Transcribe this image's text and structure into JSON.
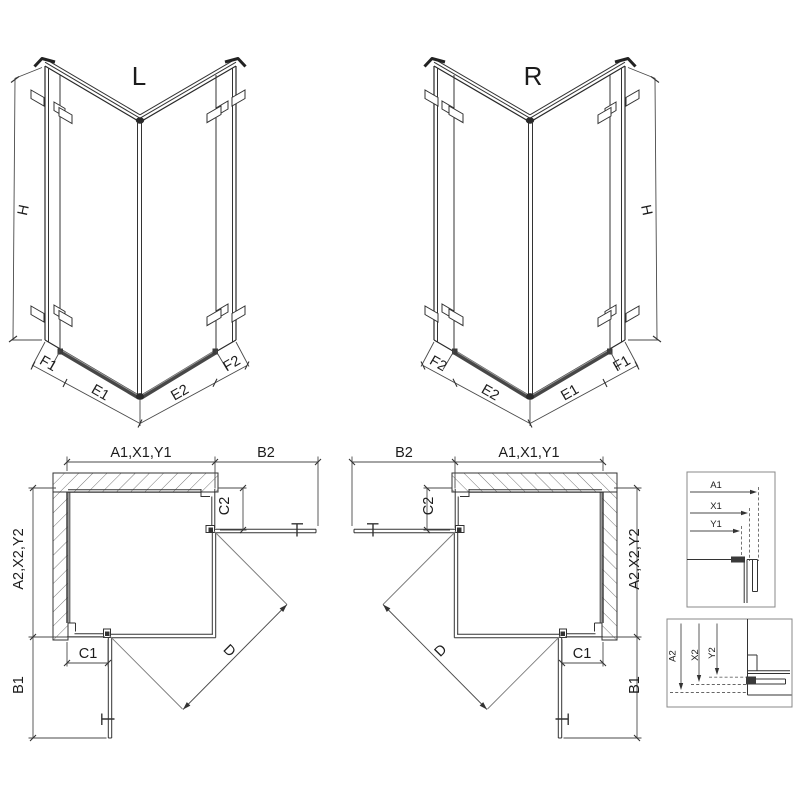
{
  "iso_left": {
    "title": "L",
    "height": "H",
    "widths": [
      "F1",
      "E1",
      "E2",
      "F2"
    ]
  },
  "iso_right": {
    "title": "R",
    "height": "H",
    "widths": [
      "F2",
      "E2",
      "E1",
      "F1"
    ]
  },
  "plan_left": {
    "width_top": "A1,X1,Y1",
    "door_width_top": "B2",
    "panel_top": "C2",
    "depth": "A2,X2,Y2",
    "panel_bottom": "C1",
    "door_width_bottom": "B1",
    "diagonal": "D"
  },
  "plan_right": {
    "width_top": "A1,X1,Y1",
    "door_width_top": "B2",
    "panel_top": "C2",
    "depth": "A2,X2,Y2",
    "panel_bottom": "C1",
    "door_width_bottom": "B1",
    "diagonal": "D"
  },
  "detail_horizontal": {
    "labels": [
      "A1",
      "X1",
      "Y1"
    ]
  },
  "detail_vertical": {
    "labels": [
      "A2",
      "X2",
      "Y2"
    ]
  },
  "colors": {
    "line": "#2a2a2a",
    "dim": "#4a4a4a",
    "rail": "#474747",
    "background": "#ffffff"
  }
}
